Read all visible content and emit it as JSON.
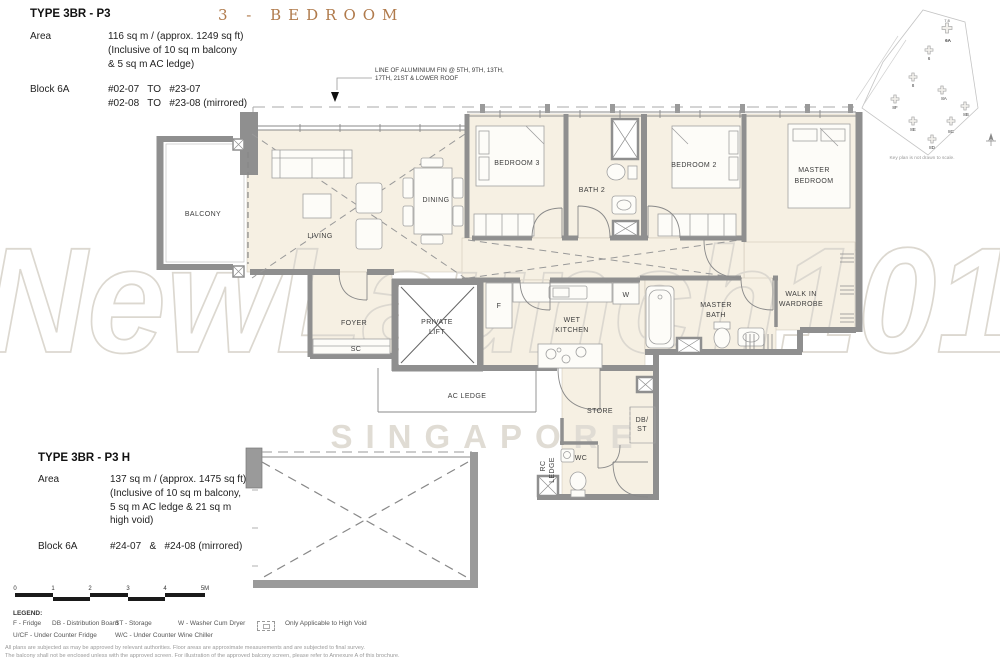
{
  "header": {
    "title": "3 - BEDROOM"
  },
  "colors": {
    "title_accent": "#b07a4b",
    "wall_gray": "#8f8f8f",
    "floor_cream": "#f6f0e3",
    "watermark_gray": "#dcd8d0"
  },
  "unit_top": {
    "type": "TYPE 3BR - P3",
    "area_label": "Area",
    "area_lines": [
      "116 sq m / (approx. 1249 sq ft)",
      "(Inclusive of 10 sq m balcony",
      "& 5 sq m AC ledge)"
    ],
    "block_label": "Block 6A",
    "block_lines": [
      "#02-07   TO   #23-07",
      "#02-08   TO   #23-08 (mirrored)"
    ]
  },
  "unit_bottom": {
    "type": "TYPE 3BR - P3 H",
    "area_label": "Area",
    "area_lines": [
      "137 sq m / (approx. 1475 sq ft)",
      "(Inclusive of 10 sq m balcony,",
      "5 sq m AC ledge & 21 sq m",
      "high void)"
    ],
    "block_label": "Block 6A",
    "block_lines": [
      "#24-07   &   #24-08 (mirrored)"
    ]
  },
  "plan": {
    "fin_note": [
      "LINE OF ALUMINIUM FIN @ 5TH, 9TH, 13TH,",
      "17TH, 21ST & LOWER ROOF"
    ],
    "labels": {
      "balcony": "BALCONY",
      "living": "LIVING",
      "dining": "DINING",
      "bedroom3": "BEDROOM 3",
      "bath2": "BATH 2",
      "bedroom2": "BEDROOM 2",
      "master1": "MASTER",
      "master2": "BEDROOM",
      "foyer": "FOYER",
      "sc": "SC",
      "lift1": "PRIVATE",
      "lift2": "LIFT",
      "fridge": "F",
      "wet1": "WET",
      "wet2": "KITCHEN",
      "washer": "W",
      "mbath1": "MASTER",
      "mbath2": "BATH",
      "wiw1": "WALK IN",
      "wiw2": "WARDROBE",
      "acledge": "AC LEDGE",
      "store": "STORE",
      "dbst1": "DB/",
      "dbst2": "ST",
      "rcledge1": "RC",
      "rcledge2": "LEDGE",
      "wc": "WC"
    }
  },
  "keyplan": {
    "caption": "Key plan is not drawn to scale.",
    "unit_nums": "7  8",
    "blocks": [
      "6A",
      "6",
      "8",
      "8A",
      "8F",
      "8B",
      "8E",
      "8C",
      "8D"
    ]
  },
  "watermark": {
    "name": "NewLaunch101",
    "sub": "SINGAPORE"
  },
  "scalebar": {
    "ticks": [
      "0",
      "1",
      "2",
      "3",
      "4",
      "5M"
    ]
  },
  "legend": {
    "title": "LEGEND:",
    "items_row1": [
      "F - Fridge",
      "DB - Distribution Board",
      "ST - Storage",
      "W - Washer Cum Dryer"
    ],
    "high_void": "Only Applicable to High Void",
    "items_row2": [
      "U/CF - Under Counter Fridge",
      "W/C - Under Counter Wine Chiller"
    ]
  },
  "disclaimer": [
    "All plans are subjected as may be approved by relevant authorities. Floor areas are approximate measurements and are subjected to final survey.",
    "The balcony shall not be enclosed unless with the approved screen. For illustration of the approved balcony screen, please refer to Annexure A of this brochure."
  ]
}
